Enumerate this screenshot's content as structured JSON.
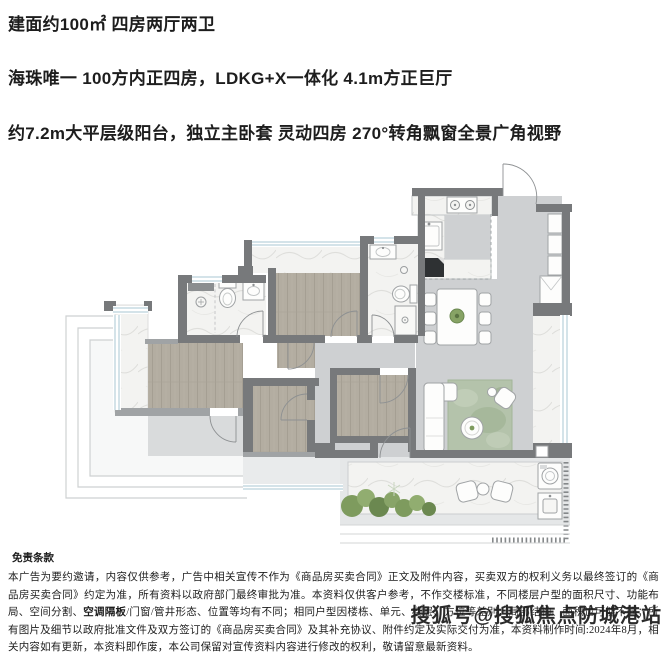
{
  "headlines": [
    {
      "text": "建面约100㎡ 四房两厅两卫"
    },
    {
      "text": "海珠唯一 100方内正四房，LDKG+X一体化 4.1m方正巨厅"
    },
    {
      "text": "约7.2m大平层级阳台，独立主卧套 灵动四房 270°转角飘窗全景广角视野"
    }
  ],
  "floor_plan": {
    "type": "apartment-floor-plan",
    "rooms": [
      "kitchen",
      "entry-foyer",
      "dining-area",
      "living-room",
      "master-bedroom",
      "walk-in-closet",
      "bedroom-2",
      "bedroom-3",
      "master-bathroom",
      "guest-bathroom",
      "balcony",
      "terrace",
      "left-balcony",
      "right-bay-window"
    ],
    "features": [
      "entry-door-arc",
      "corner-bay-window",
      "dining-table-six-chairs",
      "l-shaped-sofa",
      "green-rug",
      "coffee-table",
      "washing-machine",
      "balcony-greenery",
      "balcony-armchairs",
      "toilets",
      "showers",
      "sinks"
    ],
    "colors": {
      "wall": "#77797b",
      "wall_light": "#a0a3a5",
      "wood_floor": "#b3ada1",
      "tile_floor": "#ced0d2",
      "marble_floor": "#f3f3f1",
      "terrace_floor": "#d9dbdc",
      "balcony_floor": "#e5e7e8",
      "window_glass": "#a9c7d3",
      "rug_green": "#b4c3ab",
      "plant_green": "#7e9b5e"
    }
  },
  "disclaimer": {
    "title": "免责条款",
    "body_before_bold": "本广告为要约邀请，内容仅供参考，广告中相关宣传不作为《商品房买卖合同》正文及附件内容，买卖双方的权利义务以最终签订的《商品房买卖合同》约定为准，所有资料以政府部门最终审批为准。本资料仅供客户参考，不作交楼标准，不同楼层户型的面积尺寸、功能布局、空间分割、",
    "bold_term": "空调隔板",
    "body_after_bold": "/门窗/管井形态、位置等均有不同；相同户型因楼栋、单元、楼层、方位等差别，局部结构、面积也可能不同；所有图片及细节以政府批准文件及双方签订的《商品房买卖合同》及其补充协议、附件约定及实际交付为准，本资料制作时间:2024年8月，相关内容如有更新，本资料即作废，本公司保留对宣传资料内容进行修改的权利，敬请留意最新资料。"
  },
  "watermark": {
    "text": "搜狐号@搜狐焦点防城港站"
  }
}
